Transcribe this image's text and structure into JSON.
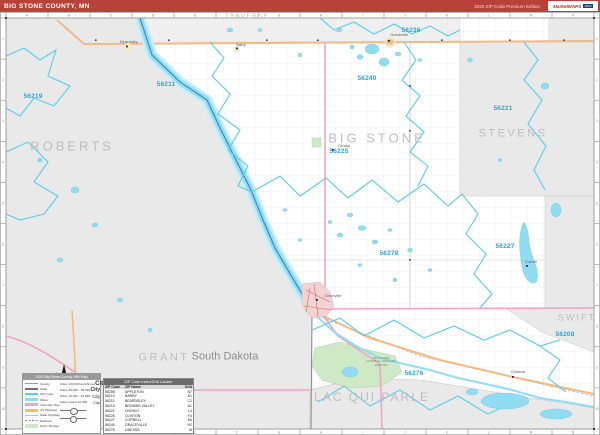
{
  "header": {
    "title": "BIG STONE COUNTY, MN",
    "edition": "2020 ZIP Code Premium Edition",
    "logo": {
      "name": "MarketMAPS",
      "badge": "2020"
    }
  },
  "map": {
    "county_labels": [
      {
        "text": "ROBERTS",
        "x": 72,
        "y": 146,
        "size": 13,
        "ls": 3
      },
      {
        "text": "TRAVERSE",
        "x": 247,
        "y": 17,
        "size": 6,
        "ls": 1.5
      },
      {
        "text": "BIG STONE",
        "x": 377,
        "y": 138,
        "size": 13,
        "ls": 3
      },
      {
        "text": "STEVENS",
        "x": 513,
        "y": 134,
        "size": 11,
        "ls": 2.5
      },
      {
        "text": "SWIFT",
        "x": 577,
        "y": 318,
        "size": 9,
        "ls": 2
      },
      {
        "text": "GRANT",
        "x": 164,
        "y": 358,
        "size": 11,
        "ls": 2.5
      },
      {
        "text": "LAC QUI PARLE",
        "x": 372,
        "y": 397,
        "size": 12,
        "ls": 2
      }
    ],
    "state_label": {
      "text": "South Dakota",
      "x": 225,
      "y": 357,
      "size": 11
    },
    "zip_labels": [
      {
        "text": "56219",
        "x": 33,
        "y": 97
      },
      {
        "text": "56211",
        "x": 166,
        "y": 85
      },
      {
        "text": "56240",
        "x": 367,
        "y": 79
      },
      {
        "text": "56236",
        "x": 411,
        "y": 31
      },
      {
        "text": "56221",
        "x": 503,
        "y": 109
      },
      {
        "text": "56225",
        "x": 339,
        "y": 152
      },
      {
        "text": "56227",
        "x": 505,
        "y": 247
      },
      {
        "text": "56278",
        "x": 389,
        "y": 254
      },
      {
        "text": "56276",
        "x": 414,
        "y": 374
      },
      {
        "text": "56208",
        "x": 565,
        "y": 335
      }
    ],
    "town_labels": [
      {
        "text": "Beardsley",
        "x": 129,
        "y": 42
      },
      {
        "text": "Barry",
        "x": 241,
        "y": 45
      },
      {
        "text": "Graceville",
        "x": 399,
        "y": 35
      },
      {
        "text": "Clinton",
        "x": 344,
        "y": 146
      },
      {
        "text": "Correll",
        "x": 531,
        "y": 262
      },
      {
        "text": "Odessa",
        "x": 518,
        "y": 372
      },
      {
        "text": "Ortonville",
        "x": 333,
        "y": 296
      }
    ],
    "refuge_label": "BIG STONE NATIONAL WILDLIFE REFUGE"
  },
  "legend": {
    "title": "2020 Big Stone County, MN Map",
    "lines": [
      {
        "label": "County",
        "color": "#9e9e9e",
        "h": 1.5
      },
      {
        "label": "State",
        "color": "#707070",
        "h": 1.5
      },
      {
        "label": "ZIP Code",
        "color": "#58cdec",
        "h": 1.5
      },
      {
        "label": "Water",
        "color": "#92dcf2",
        "h": 3
      },
      {
        "label": "Interstate Hwy",
        "color": "#f2a3ca",
        "h": 3
      },
      {
        "label": "US Highway",
        "color": "#f4b97f",
        "h": 3
      },
      {
        "label": "State Highway",
        "color": "#f2a3ca",
        "h": 1.5
      },
      {
        "label": "Railroad",
        "color": "#8a8a8a",
        "h": 1.2,
        "dashed": true
      },
      {
        "label": "Park / Refuge",
        "color": "#cfe8c6",
        "h": 4
      }
    ],
    "cities": [
      {
        "label": "Cities 100,000 and Above",
        "sample": "City",
        "size": 6,
        "bold": true
      },
      {
        "label": "Cities 25,000 - 99,999",
        "sample": "City",
        "size": 5,
        "bold": true
      },
      {
        "label": "Cities 10,000 - 24,999",
        "sample": "City",
        "size": 4.5,
        "bold": false
      },
      {
        "label": "Cities Under 10,000",
        "sample": "City",
        "size": 4,
        "bold": false
      }
    ]
  },
  "zip_table": {
    "title": "ZIP Code Index/Grid Locator",
    "columns": [
      "ZIP Code",
      "ZIP Name",
      "Grid"
    ],
    "rows": [
      [
        "56208",
        "APPLETON",
        "N7"
      ],
      [
        "56210",
        "BARRY",
        "E1"
      ],
      [
        "56211",
        "BEARDSLEY",
        "C2"
      ],
      [
        "56219",
        "BROWNS VALLEY",
        "A1"
      ],
      [
        "56221",
        "CHOKIO",
        "L4"
      ],
      [
        "56225",
        "CLINTON",
        "F4"
      ],
      [
        "56227",
        "CORRELL",
        "K6"
      ],
      [
        "56240",
        "GRACEVILLE",
        "H2"
      ],
      [
        "56276",
        "ODESSA",
        "I8"
      ],
      [
        "56278",
        "ORTONVILLE",
        "E7"
      ]
    ]
  }
}
